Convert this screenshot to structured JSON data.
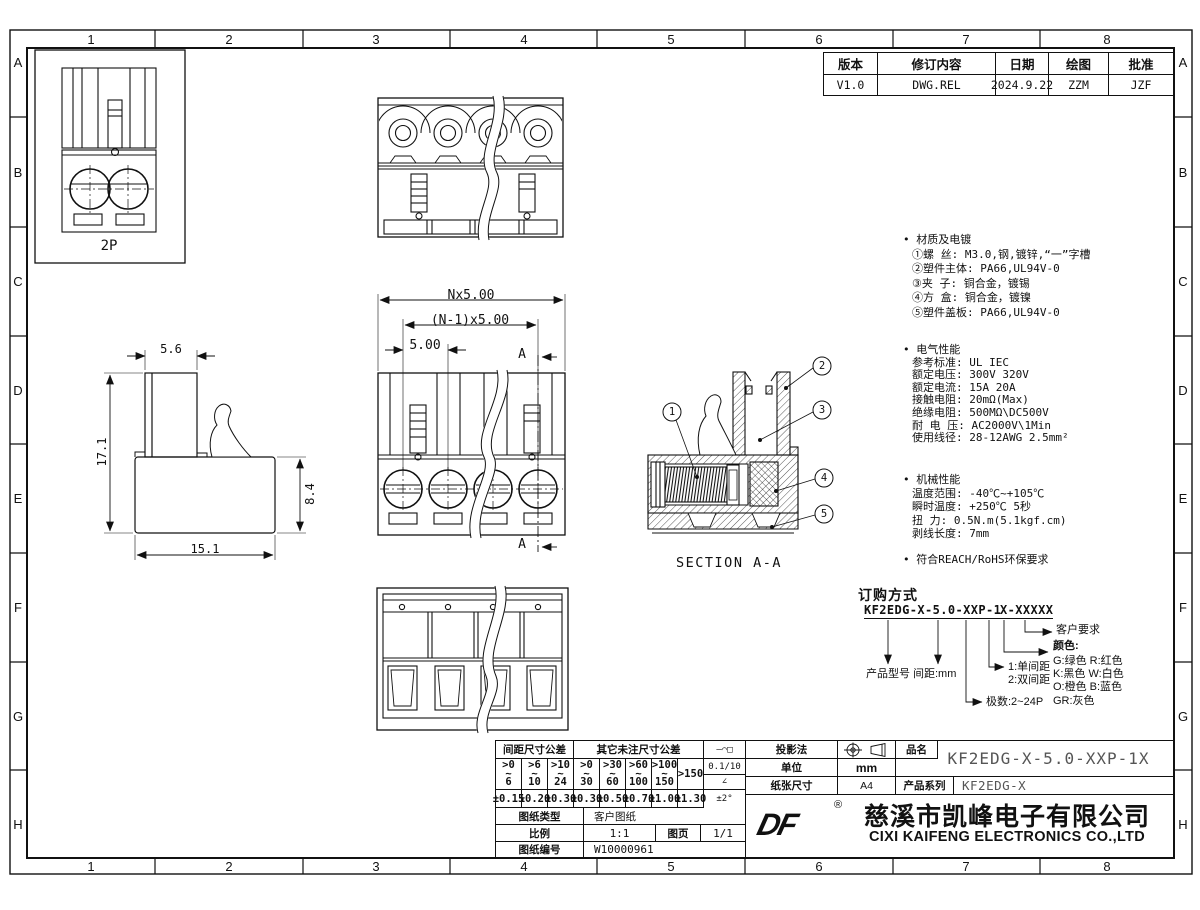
{
  "grid": {
    "cols": [
      "1",
      "2",
      "3",
      "4",
      "5",
      "6",
      "7",
      "8"
    ],
    "rows": [
      "A",
      "B",
      "C",
      "D",
      "E",
      "F",
      "G",
      "H"
    ]
  },
  "revision": {
    "headers": [
      "版本",
      "修订内容",
      "日期",
      "绘图",
      "批准"
    ],
    "values": [
      "V1.0",
      "DWG.REL",
      "2024.9.22",
      "ZZM",
      "JZF"
    ]
  },
  "views": {
    "front2p_label": "2P",
    "dim_nx": "Nx5.00",
    "dim_n1x": "(N-1)x5.00",
    "dim_pitch": "5.00",
    "section_mark": "A",
    "dim_w": "5.6",
    "dim_h": "17.1",
    "dim_bh": "8.4",
    "dim_bw": "15.1",
    "section_label": "SECTION A-A",
    "balloons": [
      "1",
      "2",
      "3",
      "4",
      "5"
    ]
  },
  "notes": {
    "bullet": "•",
    "material_title": "材质及电镀",
    "material_body": "①螺    丝: M3.0,钢,镀锌,“一”字槽\n②塑件主体: PA66,UL94V-0\n③夹    子: 铜合金，镀锡\n④方    盒: 铜合金，镀镍\n⑤塑件盖板: PA66,UL94V-0",
    "electrical_title": "电气性能",
    "electrical_body": "参考标准: UL       IEC\n额定电压: 300V     320V\n额定电流: 15A      20A\n接触电阻: 20mΩ(Max)\n绝缘电阻: 500MΩ\\DC500V\n耐 电 压: AC2000V\\1Min\n使用线径: 28-12AWG 2.5mm²",
    "mechanical_title": "机械性能",
    "mechanical_body": "温度范围: -40℃~+105℃\n瞬时温度: +250℃ 5秒\n扭    力: 0.5N.m(5.1kgf.cm)\n剥线长度: 7mm",
    "compliance": "符合REACH/RoHS环保要求"
  },
  "ordering": {
    "title": "订购方式",
    "code_main": "KF2EDG-X-5.0-XXP-1",
    "code_suffix": "X-XXXXX",
    "product_label": "产品型号",
    "pitch_label": "间距:mm",
    "poles_label": "极数:2~24P",
    "spacing_1": "1:单间距",
    "spacing_2": "2:双间距",
    "color_label": "颜色:",
    "color_list": "G:绿色  R:红色\nK:黑色  W:白色\nO:橙色  B:蓝色\nGR:灰色",
    "customer_label": "客户要求"
  },
  "titleblock": {
    "tol_pitch_header": "间距尺寸公差",
    "tol_other_header": "其它未注尺寸公差",
    "ranges": [
      ">0\n~\n6",
      ">6\n~\n10",
      ">10\n~\n24",
      ">0\n~\n30",
      ">30\n~\n60",
      ">60\n~\n100",
      ">100\n~\n150",
      ">150"
    ],
    "tols": [
      "±0.15",
      "±0.20",
      "±0.30",
      "±0.30",
      "±0.50",
      "±0.70",
      "±1.00",
      "±1.30"
    ],
    "sym_header": "—⌒□",
    "sym_flat": "0.1/10",
    "sym_angle": "∠",
    "sym_angle_tol": "±2°",
    "type_label": "图纸类型",
    "type_value": "客户图纸",
    "scale_label": "比例",
    "scale_value": "1:1",
    "page_label": "图页",
    "page_value": "1/1",
    "no_label": "图纸编号",
    "no_value": "W10000961",
    "proj_label": "投影法",
    "unit_label": "单位",
    "unit_value": "mm",
    "paper_label": "纸张尺寸",
    "paper_value": "A4",
    "name_label": "品名",
    "name_value": "KF2EDG-X-5.0-XXP-1X",
    "series_label": "产品系列",
    "series_value": "KF2EDG-X",
    "logo_text": "DF",
    "reg_mark": "®",
    "company_cn": "慈溪市凯峰电子有限公司",
    "company_en": "CIXI KAIFENG ELECTRONICS CO.,LTD"
  }
}
